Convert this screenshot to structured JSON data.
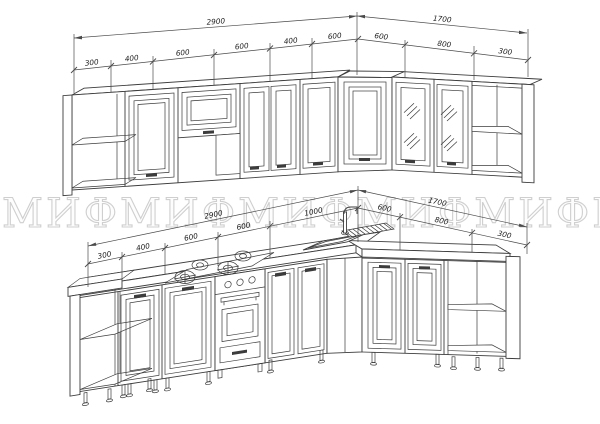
{
  "page": {
    "background": "#ffffff",
    "line_color": "#3c3c3c"
  },
  "watermark": {
    "text": "МИФ",
    "color": "#cfcfcf"
  },
  "drawings": {
    "top": {
      "kind": "wall-cabinets-elevation",
      "overall": [
        "2900",
        "1700"
      ],
      "segments": [
        "300",
        "400",
        "600",
        "600",
        "400",
        "600",
        "600",
        "800",
        "300"
      ]
    },
    "bottom": {
      "kind": "base-cabinets-elevation",
      "overall": [
        "2900",
        "1700"
      ],
      "segments": [
        "300",
        "400",
        "600",
        "600",
        "1000",
        "600",
        "800",
        "300"
      ]
    }
  }
}
